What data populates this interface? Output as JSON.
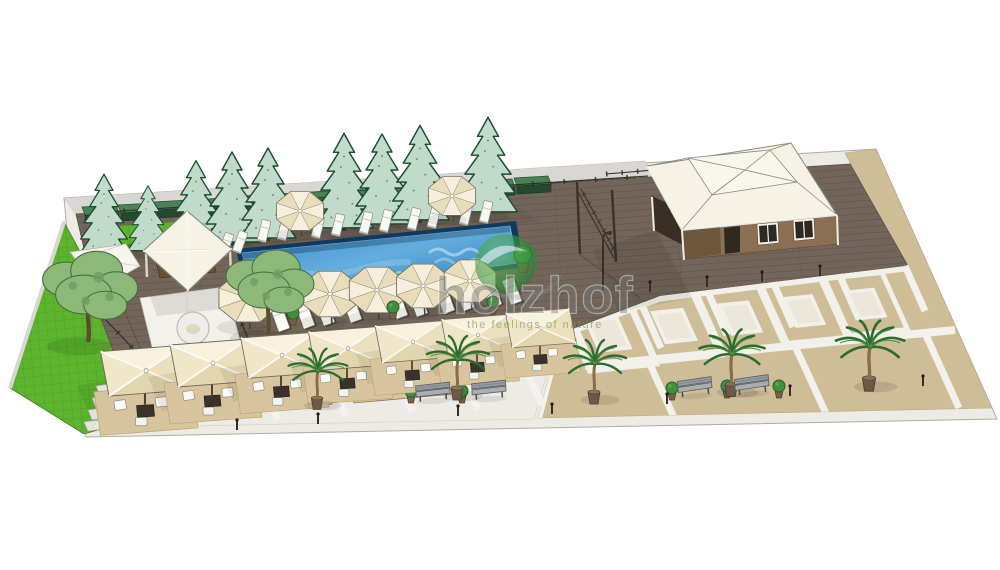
{
  "watermark": {
    "brand": "holzhof",
    "tagline": "the feelings of nature"
  },
  "palette": {
    "base": "#ecebe6",
    "deck": "#73655a",
    "tan": "#cfbd98",
    "gray_band": "#d8d7d3",
    "lawn": "#5cb42d",
    "pavement": "#edebe5",
    "pool_rim": "#10395f",
    "water_light": "#63aede",
    "water_deep": "#2d77b6",
    "canopy": "#f1e9d2",
    "roof": "#f6f2e4",
    "wall_brown": "#8a6f54",
    "hedge": "#2b5437",
    "conifer_fill": "#c0dbca",
    "logo_green": "#3f9c45",
    "brand_gray": "#787876",
    "tagline_green": "#86934b",
    "mat": "#d8c59d"
  },
  "scene": {
    "conifers": [
      {
        "x": 104,
        "y": 257,
        "s": 0.9
      },
      {
        "x": 148,
        "y": 252,
        "s": 0.72
      },
      {
        "x": 196,
        "y": 248,
        "s": 0.95
      },
      {
        "x": 232,
        "y": 244,
        "s": 1
      },
      {
        "x": 268,
        "y": 240,
        "s": 1
      },
      {
        "x": 344,
        "y": 230,
        "s": 1.05
      },
      {
        "x": 382,
        "y": 226,
        "s": 1
      },
      {
        "x": 420,
        "y": 222,
        "s": 1.05
      },
      {
        "x": 488,
        "y": 214,
        "s": 1.05
      }
    ],
    "hedges": [
      {
        "x": 100,
        "y": 216
      },
      {
        "x": 136,
        "y": 214
      },
      {
        "x": 172,
        "y": 211
      },
      {
        "x": 208,
        "y": 209
      },
      {
        "x": 244,
        "y": 206
      },
      {
        "x": 280,
        "y": 204
      },
      {
        "x": 316,
        "y": 202
      },
      {
        "x": 352,
        "y": 199
      },
      {
        "x": 388,
        "y": 197
      },
      {
        "x": 424,
        "y": 194
      },
      {
        "x": 460,
        "y": 192
      },
      {
        "x": 496,
        "y": 190
      },
      {
        "x": 532,
        "y": 187
      }
    ],
    "sun_loungers": [
      {
        "x": 264,
        "y": 231,
        "r": 14
      },
      {
        "x": 284,
        "y": 229,
        "r": 14
      },
      {
        "x": 318,
        "y": 227,
        "r": 14
      },
      {
        "x": 338,
        "y": 225,
        "r": 14
      },
      {
        "x": 366,
        "y": 223,
        "r": 14
      },
      {
        "x": 386,
        "y": 221,
        "r": 14
      },
      {
        "x": 414,
        "y": 219,
        "r": 14
      },
      {
        "x": 434,
        "y": 217,
        "r": 14
      },
      {
        "x": 466,
        "y": 214,
        "r": 14
      },
      {
        "x": 486,
        "y": 212,
        "r": 14
      },
      {
        "x": 212,
        "y": 246,
        "r": 20
      },
      {
        "x": 226,
        "y": 244,
        "r": 20
      },
      {
        "x": 240,
        "y": 242,
        "r": 20
      }
    ],
    "round_umbrellas": [
      {
        "x": 300,
        "y": 211,
        "s": 0.85
      },
      {
        "x": 452,
        "y": 196,
        "s": 0.85
      },
      {
        "x": 248,
        "y": 298,
        "s": 1.05
      },
      {
        "x": 330,
        "y": 294,
        "s": 1
      },
      {
        "x": 377,
        "y": 290,
        "s": 1
      },
      {
        "x": 423,
        "y": 286,
        "s": 0.96
      },
      {
        "x": 470,
        "y": 281,
        "s": 0.93
      }
    ],
    "pool_loungers": [
      {
        "x": 280,
        "y": 318,
        "r": -20
      },
      {
        "x": 305,
        "y": 315,
        "r": -20
      },
      {
        "x": 325,
        "y": 312,
        "r": -20
      },
      {
        "x": 352,
        "y": 309,
        "r": -20
      },
      {
        "x": 398,
        "y": 305,
        "r": -20
      },
      {
        "x": 418,
        "y": 303,
        "r": -20
      },
      {
        "x": 445,
        "y": 300,
        "r": -20
      },
      {
        "x": 465,
        "y": 297,
        "r": -20
      },
      {
        "x": 492,
        "y": 294,
        "r": -20
      },
      {
        "x": 512,
        "y": 291,
        "r": -20
      }
    ],
    "square_umbrellas": [
      {
        "x": 145,
        "y": 377,
        "s": 1.06
      },
      {
        "x": 212,
        "y": 369,
        "s": 1
      },
      {
        "x": 281,
        "y": 361,
        "s": 0.96
      },
      {
        "x": 347,
        "y": 354,
        "s": 0.92
      },
      {
        "x": 412,
        "y": 347,
        "s": 0.88
      },
      {
        "x": 477,
        "y": 340,
        "s": 0.85
      },
      {
        "x": 540,
        "y": 333,
        "s": 0.82
      }
    ],
    "palms": [
      {
        "x": 317,
        "y": 398,
        "s": 0.95
      },
      {
        "x": 457,
        "y": 388,
        "s": 1
      },
      {
        "x": 594,
        "y": 392,
        "s": 1
      },
      {
        "x": 731,
        "y": 384,
        "s": 1.05
      },
      {
        "x": 869,
        "y": 378,
        "s": 1.1
      }
    ],
    "plaza_motifs": [
      {
        "x": 608,
        "y": 334,
        "s": 1
      },
      {
        "x": 674,
        "y": 326,
        "s": 0.97
      },
      {
        "x": 740,
        "y": 318,
        "s": 0.94
      },
      {
        "x": 804,
        "y": 311,
        "s": 0.9
      },
      {
        "x": 866,
        "y": 304,
        "s": 0.87
      }
    ],
    "benches": [
      {
        "x": 433,
        "y": 393,
        "r": -3
      },
      {
        "x": 489,
        "y": 391,
        "r": -3
      },
      {
        "x": 695,
        "y": 388,
        "r": -5
      },
      {
        "x": 752,
        "y": 386,
        "r": -5
      }
    ],
    "shrub_pots": [
      {
        "x": 293,
        "y": 318,
        "s": 1
      },
      {
        "x": 393,
        "y": 312,
        "s": 1
      },
      {
        "x": 493,
        "y": 307,
        "s": 1
      },
      {
        "x": 523,
        "y": 262,
        "s": 1.5
      },
      {
        "x": 411,
        "y": 396,
        "s": 1
      },
      {
        "x": 462,
        "y": 396,
        "s": 1
      },
      {
        "x": 672,
        "y": 393,
        "s": 1
      },
      {
        "x": 727,
        "y": 391,
        "s": 1
      },
      {
        "x": 779,
        "y": 391,
        "s": 1
      }
    ],
    "bollards": [
      {
        "x": 650,
        "y": 292
      },
      {
        "x": 707,
        "y": 287
      },
      {
        "x": 762,
        "y": 282
      },
      {
        "x": 820,
        "y": 276
      },
      {
        "x": 667,
        "y": 404
      },
      {
        "x": 790,
        "y": 396
      },
      {
        "x": 923,
        "y": 386
      },
      {
        "x": 552,
        "y": 414
      },
      {
        "x": 237,
        "y": 430
      },
      {
        "x": 318,
        "y": 424
      },
      {
        "x": 458,
        "y": 416
      }
    ],
    "shade_trees": [
      {
        "x": 88,
        "y": 342,
        "s": 1.08
      },
      {
        "x": 268,
        "y": 334,
        "s": 1
      }
    ]
  }
}
